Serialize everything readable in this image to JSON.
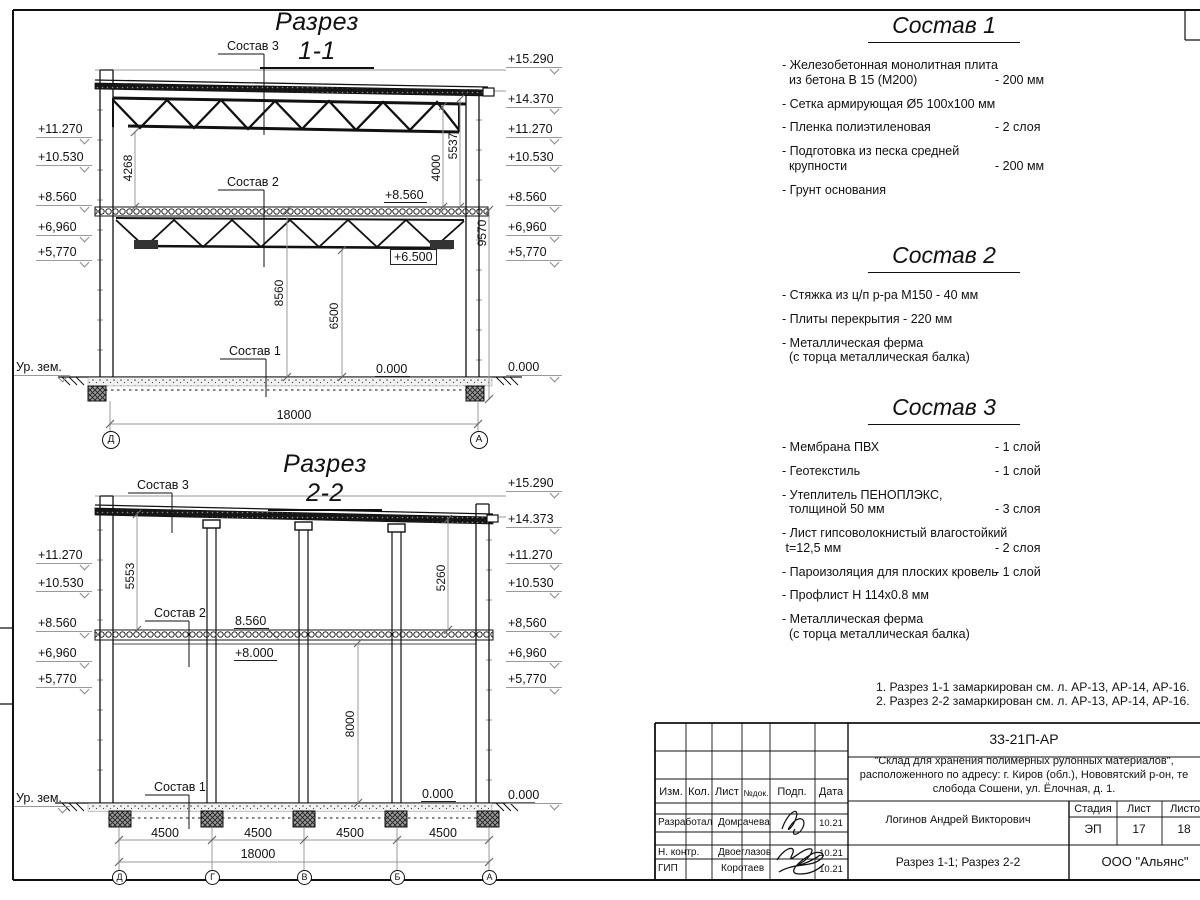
{
  "drawing": {
    "s11": {
      "title": "Разрез 1-1",
      "left_marks": [
        "+11.270",
        "+10.530",
        "+8.560",
        "+6,960",
        "+5,770"
      ],
      "right_marks": [
        "+15.290",
        "+14.370",
        "+11.270",
        "+10.530",
        "+8.560",
        "+6,960",
        "+5,770",
        "0.000"
      ],
      "ground_label": "Ур. зем.",
      "leaders": [
        "Состав 3",
        "Состав 2",
        "Состав 1"
      ],
      "level_labels": {
        "slab": "+8.560",
        "truss": "+6.500",
        "floor": "0.000"
      },
      "vdims": [
        "4268",
        "8560",
        "6500",
        "4000",
        "5537",
        "9570"
      ],
      "hdim_total": "18000",
      "axis_bubbles": [
        "Д",
        "А"
      ]
    },
    "s22": {
      "title": "Разрез 2-2",
      "left_marks": [
        "+11.270",
        "+10.530",
        "+8.560",
        "+6,960",
        "+5,770"
      ],
      "right_marks": [
        "+15.290",
        "+14.373",
        "+11.270",
        "+10.530",
        "+8,560",
        "+6,960",
        "+5,770",
        "0.000"
      ],
      "ground_label": "Ур. зем.",
      "leaders": [
        "Состав 3",
        "Состав 2",
        "Состав 1"
      ],
      "level_labels": {
        "slab": "8.560",
        "slab2": "+8.000",
        "floor": "0.000"
      },
      "vdims": [
        "5553",
        "5260",
        "8000"
      ],
      "hdims": [
        "4500",
        "4500",
        "4500",
        "4500"
      ],
      "hdim_total": "18000",
      "axis_bubbles": [
        "Д",
        "Г",
        "В",
        "Б",
        "А"
      ]
    }
  },
  "compositions": [
    {
      "title": "Состав 1",
      "items": [
        {
          "name": "- Железобетонная  монолитная плита\n  из бетона В 15 (М200)",
          "value": "- 200 мм"
        },
        {
          "name": "- Сетка армирующая Ø5 100х100 мм",
          "value": ""
        },
        {
          "name": "- Пленка полиэтиленовая",
          "value": "-  2 слоя"
        },
        {
          "name": "- Подготовка из песка средней\n  крупности",
          "value": "- 200 мм"
        },
        {
          "name": "- Грунт основания",
          "value": ""
        }
      ]
    },
    {
      "title": "Состав 2",
      "items": [
        {
          "name": "- Стяжка из ц/п р-ра М150 - 40 мм",
          "value": ""
        },
        {
          "name": "- Плиты перекрытия - 220 мм",
          "value": ""
        },
        {
          "name": "- Металлическая ферма\n  (с торца металлическая балка)",
          "value": ""
        }
      ]
    },
    {
      "title": "Состав 3",
      "items": [
        {
          "name": "- Мембрана ПВХ",
          "value": "- 1 слой"
        },
        {
          "name": "- Геотекстиль",
          "value": "- 1 слой"
        },
        {
          "name": "- Утеплитель ПЕНОПЛЭКС,\n  толщиной 50 мм",
          "value": "- 3 слоя"
        },
        {
          "name": "- Лист гипсоволокнистый влагостойкий\n t=12,5 мм",
          "value": "- 2 слоя"
        },
        {
          "name": "- Пароизоляция для плоских кровель",
          "value": "- 1 слой"
        },
        {
          "name": "- Профлист Н 114х0.8 мм",
          "value": ""
        },
        {
          "name": "- Металлическая ферма\n  (с торца металлическая балка)",
          "value": ""
        }
      ]
    }
  ],
  "notes": [
    "1. Разрез 1-1 замаркирован см. л. АР-13, АР-14, АР-16.",
    "2. Разрез 2-2 замаркирован см. л. АР-13, АР-14, АР-16."
  ],
  "stamp": {
    "doc_number": "33-21П-АР",
    "project_line1": "\"Склад для хранения полимерных рулонных материалов\",",
    "project_line2": "расположенного по адресу: г. Киров (обл.), Нововятский р-он, те",
    "project_line3": "слобода Сошени, ул. Ёлочная, д. 1.",
    "cols": [
      "Изм.",
      "Кол.",
      "Лист",
      "№док.",
      "Подп.",
      "Дата"
    ],
    "rows": [
      {
        "role": "Разработал",
        "name": "Домрачева",
        "date": "10.21"
      },
      {
        "role": "Н. контр.",
        "name": "Двоеглазов",
        "date": "10.21"
      },
      {
        "role": "ГИП",
        "name": "Коротаев",
        "date": "10.21"
      }
    ],
    "author": "Логинов Андрей Викторович",
    "stage_label": "Стадия",
    "sheet_label": "Лист",
    "sheets_label": "Листов",
    "stage": "ЭП",
    "sheet": "17",
    "sheets": "18",
    "content_title": "Разрез 1-1; Разрез 2-2",
    "company": "ООО \"Альянс\"",
    "line_color": "#111111"
  }
}
